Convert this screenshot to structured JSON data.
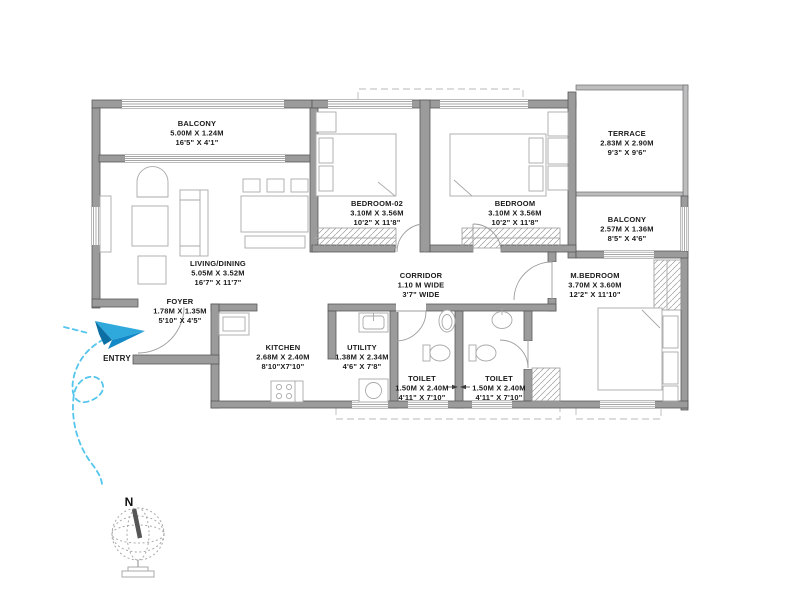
{
  "plan": {
    "entry_label": "ENTRY",
    "compass_label": "N",
    "colors": {
      "wall_fill": "#9B9B9B",
      "wall_outline": "#58595B",
      "thin_line": "#A9A9A9",
      "text": "#1A1A1A",
      "entry_blue_light": "#2FA8DC",
      "entry_blue_mid": "#1489C8",
      "entry_blue_dark": "#0B6FA4",
      "trail": "#54C5EC"
    },
    "rooms": [
      {
        "id": "balcony-top",
        "name": "BALCONY",
        "metric": "5.00M X 1.24M",
        "imperial": "16'5\" X 4'1\""
      },
      {
        "id": "living-dining",
        "name": "LIVING/DINING",
        "metric": "5.05M X 3.52M",
        "imperial": "16'7\" X 11'7\""
      },
      {
        "id": "bedroom-02",
        "name": "BEDROOM-02",
        "metric": "3.10M X 3.56M",
        "imperial": "10'2\" X 11'8\""
      },
      {
        "id": "bedroom",
        "name": "BEDROOM",
        "metric": "3.10M X 3.56M",
        "imperial": "10'2\" X 11'8\""
      },
      {
        "id": "terrace",
        "name": "TERRACE",
        "metric": "2.83M X 2.90M",
        "imperial": "9'3\" X 9'6\""
      },
      {
        "id": "balcony-right",
        "name": "BALCONY",
        "metric": "2.57M X 1.36M",
        "imperial": "8'5\" X 4'6\""
      },
      {
        "id": "corridor",
        "name": "CORRIDOR",
        "metric": "1.10 M WIDE",
        "imperial": "3'7\" WIDE"
      },
      {
        "id": "m-bedroom",
        "name": "M.BEDROOM",
        "metric": "3.70M X 3.60M",
        "imperial": "12'2\" X 11'10\""
      },
      {
        "id": "foyer",
        "name": "FOYER",
        "metric": "1.78M X 1.35M",
        "imperial": "5'10\" X 4'5\""
      },
      {
        "id": "kitchen",
        "name": "KITCHEN",
        "metric": "2.68M X 2.40M",
        "imperial": "8'10\"X7'10\""
      },
      {
        "id": "utility",
        "name": "UTILITY",
        "metric": "1.38M X 2.34M",
        "imperial": "4'6\" X 7'8\""
      },
      {
        "id": "toilet-1",
        "name": "TOILET",
        "metric": "1.50M X 2.40M",
        "imperial": "4'11\" X 7'10\""
      },
      {
        "id": "toilet-2",
        "name": "TOILET",
        "metric": "1.50M X 2.40M",
        "imperial": "4'11\" X 7'10\""
      }
    ]
  }
}
